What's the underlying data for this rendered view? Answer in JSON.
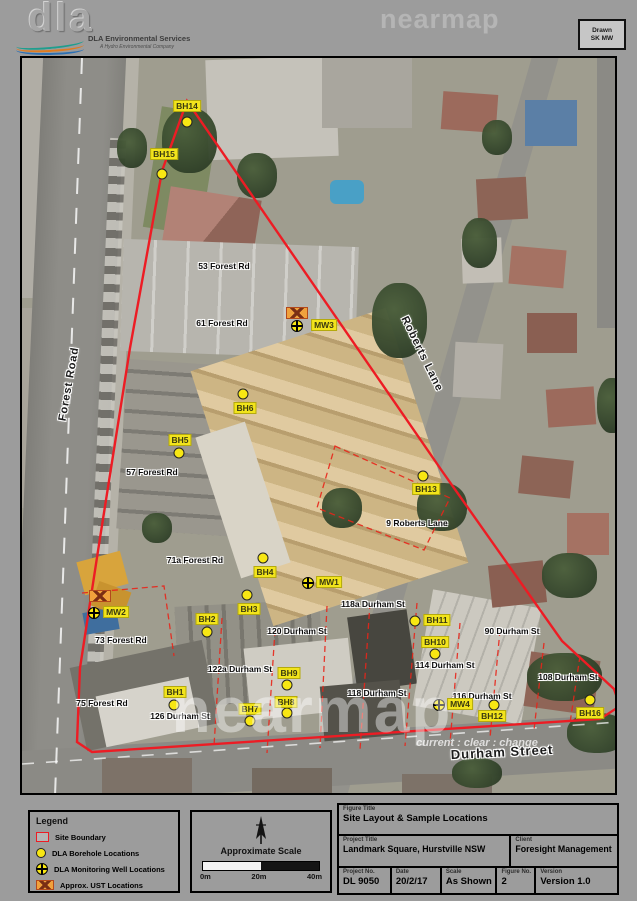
{
  "header": {
    "logo": {
      "mark": "dla",
      "name": "DLA Environmental Services",
      "tagline": "A Hydro Environmental Company"
    },
    "stamp": {
      "line1": "Drawn",
      "line2": "SK MW"
    },
    "watermark": "nearmap"
  },
  "map": {
    "street_labels": [
      {
        "text": "Forest Road",
        "x": 47,
        "y": 326,
        "rot": -80,
        "size": 11
      },
      {
        "text": "Roberts Lane",
        "x": 400,
        "y": 296,
        "rot": 64,
        "size": 11
      },
      {
        "text": "Durham Street",
        "x": 480,
        "y": 694,
        "rot": -3,
        "size": 13
      }
    ],
    "address_labels": [
      {
        "text": "53 Forest Rd",
        "x": 202,
        "y": 208
      },
      {
        "text": "61 Forest Rd",
        "x": 200,
        "y": 265
      },
      {
        "text": "57 Forest Rd",
        "x": 130,
        "y": 414
      },
      {
        "text": "71a Forest Rd",
        "x": 173,
        "y": 502
      },
      {
        "text": "73 Forest Rd",
        "x": 99,
        "y": 582
      },
      {
        "text": "75 Forest Rd",
        "x": 80,
        "y": 645
      },
      {
        "text": "9 Roberts Lane",
        "x": 395,
        "y": 465
      },
      {
        "text": "118a Durham St",
        "x": 351,
        "y": 546
      },
      {
        "text": "120 Durham St",
        "x": 275,
        "y": 573
      },
      {
        "text": "122a Durham St",
        "x": 218,
        "y": 611
      },
      {
        "text": "126 Durham St",
        "x": 158,
        "y": 658
      },
      {
        "text": "90 Durham St",
        "x": 490,
        "y": 573
      },
      {
        "text": "114 Durham St",
        "x": 423,
        "y": 607
      },
      {
        "text": "116 Durham St",
        "x": 460,
        "y": 638
      },
      {
        "text": "118 Durham St",
        "x": 355,
        "y": 635
      },
      {
        "text": "108 Durham St",
        "x": 546,
        "y": 619
      }
    ],
    "markers": [
      {
        "id": "BH14",
        "type": "borehole",
        "sx": 165,
        "sy": 64,
        "tx": 165,
        "ty": 48
      },
      {
        "id": "BH15",
        "type": "borehole",
        "sx": 140,
        "sy": 116,
        "tx": 142,
        "ty": 96
      },
      {
        "id": "MW3",
        "type": "well",
        "sx": 275,
        "sy": 268,
        "tx": 302,
        "ty": 267
      },
      {
        "id": "BH6",
        "type": "borehole",
        "sx": 221,
        "sy": 336,
        "tx": 223,
        "ty": 350
      },
      {
        "id": "BH5",
        "type": "borehole",
        "sx": 157,
        "sy": 395,
        "tx": 158,
        "ty": 382
      },
      {
        "id": "BH13",
        "type": "borehole",
        "sx": 401,
        "sy": 418,
        "tx": 404,
        "ty": 431
      },
      {
        "id": "BH4",
        "type": "borehole",
        "sx": 241,
        "sy": 500,
        "tx": 243,
        "ty": 514
      },
      {
        "id": "MW1",
        "type": "well",
        "sx": 286,
        "sy": 525,
        "tx": 307,
        "ty": 524
      },
      {
        "id": "BH3",
        "type": "borehole",
        "sx": 225,
        "sy": 537,
        "tx": 227,
        "ty": 551
      },
      {
        "id": "BH2",
        "type": "borehole",
        "sx": 185,
        "sy": 574,
        "tx": 185,
        "ty": 561
      },
      {
        "id": "MW2",
        "type": "well",
        "sx": 72,
        "sy": 555,
        "tx": 94,
        "ty": 554
      },
      {
        "id": "BH11",
        "type": "borehole",
        "sx": 393,
        "sy": 563,
        "tx": 415,
        "ty": 562
      },
      {
        "id": "BH10",
        "type": "borehole",
        "sx": 413,
        "sy": 596,
        "tx": 413,
        "ty": 584
      },
      {
        "id": "BH9",
        "type": "borehole",
        "sx": 265,
        "sy": 627,
        "tx": 267,
        "ty": 615
      },
      {
        "id": "BH1",
        "type": "borehole",
        "sx": 152,
        "sy": 647,
        "tx": 153,
        "ty": 634
      },
      {
        "id": "BH7",
        "type": "borehole",
        "sx": 228,
        "sy": 663,
        "tx": 228,
        "ty": 651
      },
      {
        "id": "BH8",
        "type": "borehole",
        "sx": 265,
        "sy": 655,
        "tx": 264,
        "ty": 644
      },
      {
        "id": "MW4",
        "type": "well",
        "sx": 417,
        "sy": 647,
        "tx": 438,
        "ty": 646
      },
      {
        "id": "BH12",
        "type": "borehole",
        "sx": 472,
        "sy": 647,
        "tx": 470,
        "ty": 658
      },
      {
        "id": "BH16",
        "type": "borehole",
        "sx": 568,
        "sy": 642,
        "tx": 568,
        "ty": 655
      }
    ],
    "usts": [
      {
        "x": 275,
        "y": 255
      },
      {
        "x": 78,
        "y": 538
      }
    ],
    "watermark": {
      "big": "nearmap",
      "small": "current : clear : change"
    }
  },
  "legend": {
    "title": "Legend",
    "items": [
      {
        "icon": "site-boundary",
        "label": "Site Boundary"
      },
      {
        "icon": "borehole",
        "label": "DLA Borehole Locations"
      },
      {
        "icon": "monitoring-well",
        "label": "DLA Monitoring Well Locations"
      },
      {
        "icon": "ust",
        "label": "Approx. UST Locations"
      }
    ]
  },
  "scale": {
    "title": "Approximate Scale",
    "ticks": [
      "0m",
      "20m",
      "40m"
    ]
  },
  "titleblock": {
    "figure_title_label": "Figure Title",
    "figure_title": "Site Layout & Sample Locations",
    "project_title_label": "Project Title",
    "project_title": "Landmark Square, Hurstville NSW",
    "client_label": "Client",
    "client": "Foresight Management",
    "cells": [
      {
        "label": "Project No.",
        "value": "DL 9050"
      },
      {
        "label": "Date",
        "value": "20/2/17"
      },
      {
        "label": "Scale",
        "value": "As Shown"
      },
      {
        "label": "Figure No.",
        "value": "2"
      },
      {
        "label": "Version",
        "value": "Version 1.0"
      }
    ]
  },
  "colors": {
    "boundary_red": "#ed1c24",
    "marker_yellow": "#f8e713",
    "ust_orange": "#f0a13c",
    "page_gray": "#9c9c9c"
  }
}
